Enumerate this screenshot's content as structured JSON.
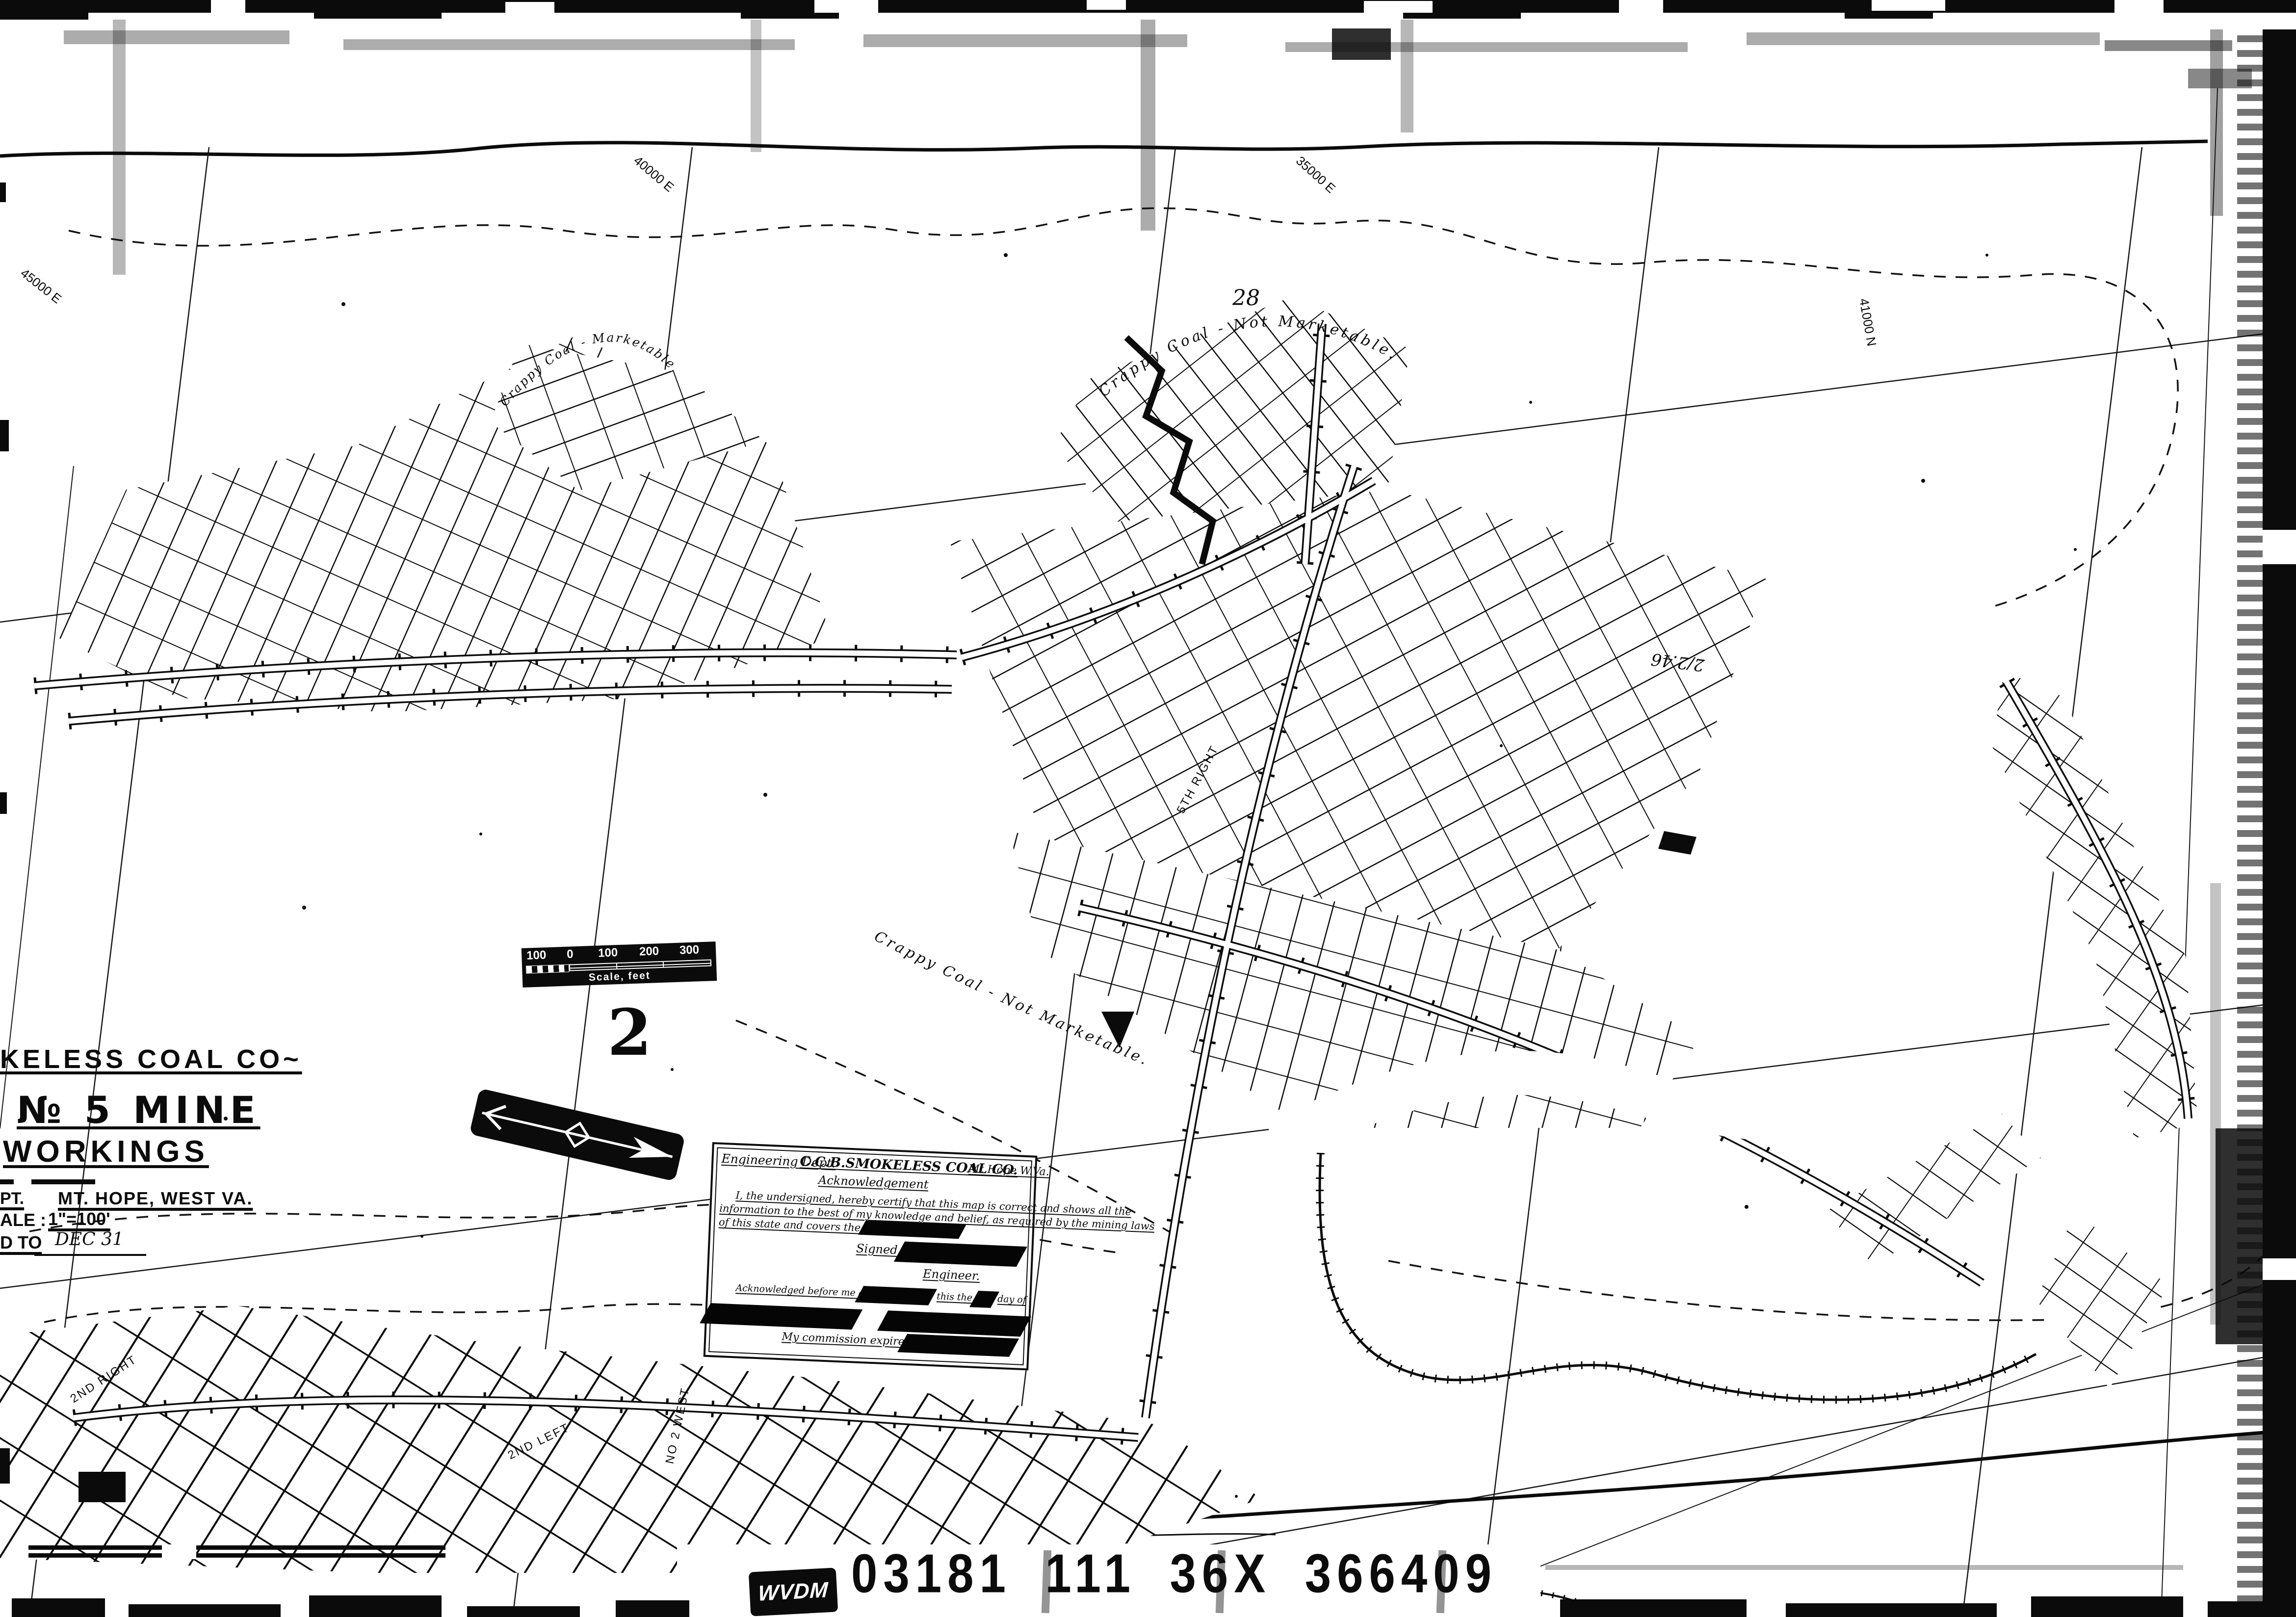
{
  "sheet_number": "2",
  "film": {
    "archive_code": "WVDM",
    "id_groups": [
      "03181",
      "111",
      "36X",
      "366409"
    ]
  },
  "title_block": {
    "company_line": "KELESS COAL CO~",
    "mine_line": "№ 5 MINE",
    "workings_line": "WORKINGS",
    "dept_fragment": "PT.",
    "location": "MT. HOPE, WEST VA.",
    "scale_fragment": "ALE :",
    "scale_value": "1\"=100'",
    "extended_fragment": "D TO",
    "extended_value": "DEC 31"
  },
  "scale_bar": {
    "ticks": [
      "100",
      "0",
      "100",
      "200",
      "300"
    ],
    "caption": "Scale, feet"
  },
  "acknowledgement": {
    "dept": "Engineering Dept.",
    "company": "C.C.B.SMOKELESS COAL CO.",
    "location": "Mt.Hope W.Va.",
    "heading": "Acknowledgement",
    "body_1": "I, the undersigned, hereby certify that this map is correct and shows all the",
    "body_2": "information to the best of my knowledge and belief, as required by the mining laws",
    "body_3": "of this state and covers the period ending",
    "signed_label": "Signed",
    "engineer_label": "Engineer.",
    "ack_line_1": "Acknowledged before me a",
    "ack_line_2": "this the",
    "ack_line_3": "day of",
    "commission_label": "My commission expires"
  },
  "map_notes": {
    "crappy_coal_top": "Crappy  Coal  -  Not  Marketable.",
    "crappy_coal_west": "Crappy Coal - Marketable.",
    "crappy_coal_south": "Crappy  Coal  -  Not  Marketable.",
    "number_28": "28",
    "handwritten_date": "2/2.46"
  },
  "grid_labels": [
    {
      "text": "45000 E"
    },
    {
      "text": "40000 E"
    },
    {
      "text": "35000 E"
    },
    {
      "text": "41000 N"
    }
  ],
  "entry_labels": [
    {
      "text": "2ND RIGHT"
    },
    {
      "text": "2ND LEFT"
    },
    {
      "text": "5TH RIGHT"
    },
    {
      "text": "NO 2 WEST"
    }
  ]
}
